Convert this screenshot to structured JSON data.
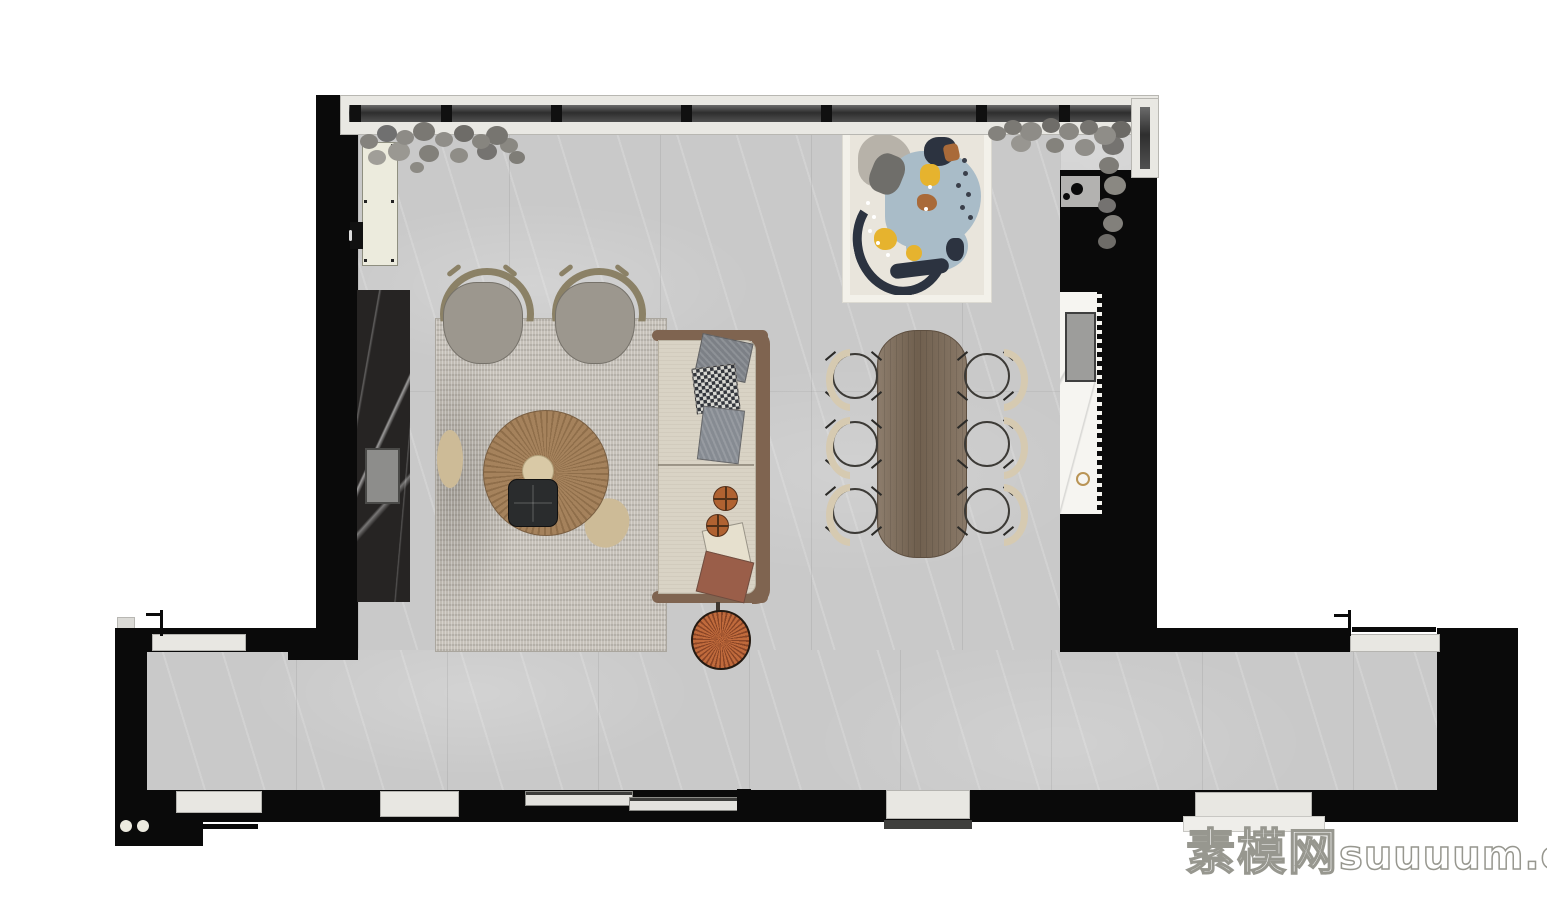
{
  "watermark": {
    "site_name_cn": "素模网",
    "site_domain": "suuuum.com"
  },
  "palette": {
    "wall_black": "#0a0a0a",
    "floor_gray_marble": "#c9c9c9",
    "rug_gray": "#c6c1b9",
    "sofa_cream": "#d9d3c5",
    "wood_frame": "#7f6450",
    "dining_table_wood": "#7c6a57",
    "coffee_table_rattan": "#a5825c",
    "accent_rust": "#b06231",
    "dining_chair_cream": "#d6cab1",
    "lounge_chair_gray": "#9c978e",
    "lounge_chair_frame_olive": "#8b8166",
    "kitchen_counter_marble": "#f6f5f1",
    "feature_wall_dark_marble": "#262423",
    "cabinet_cream": "#ecebdd",
    "window_frame": "#e9e8e3",
    "artwork_blue": "#a9bcc8",
    "artwork_navy": "#2c3340",
    "artwork_yellow": "#e6b32e",
    "artwork_rust": "#a96a39"
  },
  "counts": {
    "dining_chairs": 6,
    "lounge_chairs": 2,
    "swing_doors": 3,
    "sliding_door_panels": 2,
    "bottom_wall_openings": 5,
    "ball_pillows": 2
  },
  "inventory": {
    "living_area": [
      "area-rug",
      "sofa",
      "throw-pillows",
      "ball-pillows",
      "round-coffee-table",
      "serving-tray",
      "floor-cushions",
      "floor-pouf",
      "lounge-chairs",
      "tv-feature-wall",
      "tall-cabinet",
      "speaker-box"
    ],
    "dining_area": [
      "dining-table",
      "dining-chairs",
      "abstract-art-rug"
    ],
    "kitchen": [
      "kitchen-counter",
      "sink",
      "cooktop",
      "faucet"
    ],
    "architecture": [
      "window-wall",
      "corner-window",
      "indoor-plants",
      "hallway",
      "entry-doors",
      "sliding-door",
      "threshold-steps",
      "column-dots"
    ]
  }
}
